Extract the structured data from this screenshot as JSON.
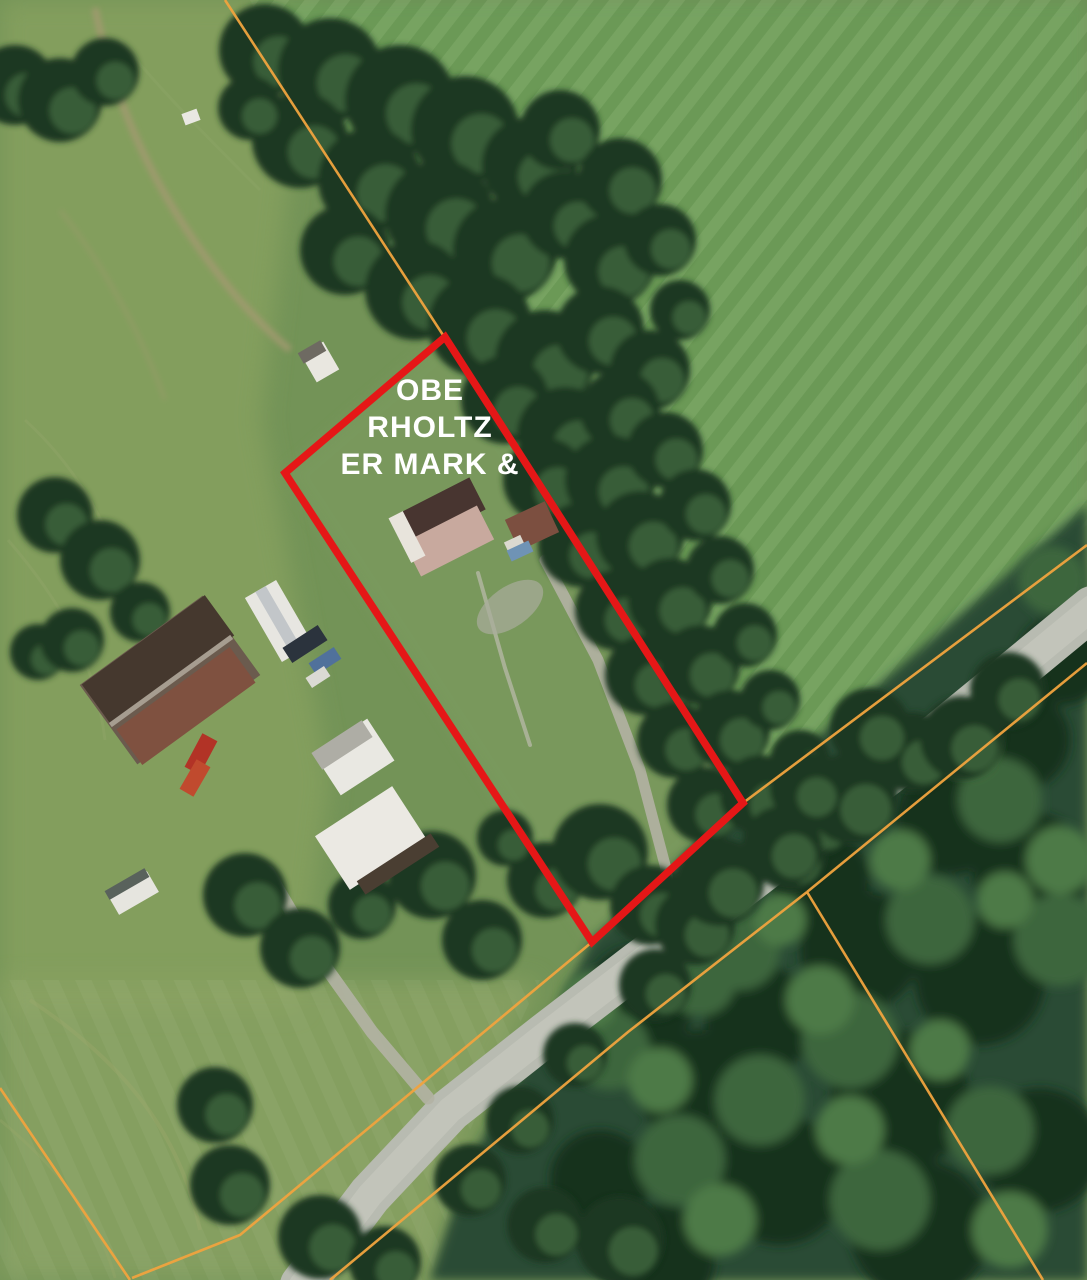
{
  "map": {
    "description": "Aerial parcel map with highlighted parcel",
    "label": {
      "full_text": "OBERHOLTZER MARK &",
      "line1": "OBE",
      "line2": "RHOLTZ",
      "line3": "ER MARK &"
    },
    "colors": {
      "highlight": "#e51717",
      "boundary": "#f0a33e",
      "label": "#ffffff",
      "road": "#b8bbb1",
      "road_center": "#c7cabe",
      "driveway": "#b3b3a4",
      "tree_dark": "#1d3823",
      "tree_light": "#55824b",
      "field_base": "#739357",
      "field_olive": "#86a05f",
      "field_bright": "#6f9f5a",
      "parcel_grass": "#7d9c60",
      "forest": "#2b4c34",
      "dirt": "#a59a72"
    },
    "red_parcel_points": "445,337 743,803 592,942 285,473",
    "orange_lines": [
      "225,0 443,335",
      "1087,545 743,803 592,942 240,1235 132,1278",
      "1087,663 807,892",
      "807,892 1043,1280",
      "807,892 628,1032 330,1280",
      "0,1088 130,1280"
    ],
    "road": {
      "main": "302,1285 370,1195 450,1110 545,1035 640,962 730,895 830,818 940,733 1035,655 1092,608",
      "farm_drive": "268,872 315,952 372,1032 428,1098",
      "parcel_drive": "545,560 598,660 640,770 665,865 680,945",
      "footpath": "478,573 505,668 530,745"
    },
    "scene": {
      "trees": [
        [
          265,
          50,
          46
        ],
        [
          330,
          70,
          52
        ],
        [
          400,
          100,
          55
        ],
        [
          465,
          130,
          54
        ],
        [
          530,
          165,
          48
        ],
        [
          300,
          140,
          48
        ],
        [
          370,
          180,
          52
        ],
        [
          440,
          215,
          55
        ],
        [
          505,
          250,
          52
        ],
        [
          565,
          215,
          44
        ],
        [
          610,
          260,
          46
        ],
        [
          345,
          250,
          45
        ],
        [
          415,
          290,
          50
        ],
        [
          480,
          325,
          52
        ],
        [
          545,
          360,
          50
        ],
        [
          600,
          330,
          44
        ],
        [
          650,
          370,
          40
        ],
        [
          560,
          130,
          40
        ],
        [
          620,
          180,
          42
        ],
        [
          660,
          240,
          36
        ],
        [
          680,
          310,
          30
        ],
        [
          505,
          400,
          44
        ],
        [
          565,
          435,
          48
        ],
        [
          620,
          410,
          40
        ],
        [
          545,
          480,
          42
        ],
        [
          610,
          480,
          45
        ],
        [
          665,
          450,
          38
        ],
        [
          580,
          545,
          42
        ],
        [
          640,
          535,
          44
        ],
        [
          695,
          505,
          36
        ],
        [
          615,
          610,
          40
        ],
        [
          670,
          600,
          42
        ],
        [
          720,
          570,
          34
        ],
        [
          645,
          675,
          40
        ],
        [
          700,
          665,
          40
        ],
        [
          745,
          635,
          32
        ],
        [
          675,
          740,
          38
        ],
        [
          730,
          730,
          40
        ],
        [
          770,
          700,
          30
        ],
        [
          705,
          805,
          38
        ],
        [
          760,
          795,
          40
        ],
        [
          800,
          760,
          30
        ],
        [
          790,
          855,
          36
        ],
        [
          820,
          825,
          30
        ],
        [
          250,
          108,
          32
        ],
        [
          15,
          85,
          40
        ],
        [
          60,
          100,
          42
        ],
        [
          105,
          72,
          34
        ],
        [
          55,
          515,
          38
        ],
        [
          100,
          560,
          40
        ],
        [
          140,
          612,
          30
        ],
        [
          38,
          652,
          28
        ],
        [
          72,
          640,
          32
        ],
        [
          245,
          895,
          42
        ],
        [
          300,
          948,
          40
        ],
        [
          362,
          905,
          34
        ],
        [
          432,
          875,
          44
        ],
        [
          482,
          940,
          40
        ],
        [
          545,
          880,
          38
        ],
        [
          505,
          838,
          28
        ],
        [
          600,
          852,
          48
        ],
        [
          650,
          905,
          40
        ],
        [
          215,
          1105,
          38
        ],
        [
          230,
          1185,
          40
        ],
        [
          320,
          1237,
          42
        ],
        [
          385,
          1262,
          36
        ],
        [
          470,
          1180,
          36
        ],
        [
          520,
          1120,
          34
        ],
        [
          575,
          1055,
          32
        ],
        [
          620,
          1240,
          44
        ],
        [
          545,
          1225,
          38
        ],
        [
          695,
          925,
          40
        ],
        [
          655,
          985,
          36
        ],
        [
          720,
          882,
          44
        ],
        [
          782,
          846,
          40
        ],
        [
          852,
          798,
          46
        ],
        [
          912,
          752,
          40
        ],
        [
          962,
          738,
          42
        ],
        [
          870,
          728,
          40
        ],
        [
          806,
          788,
          36
        ],
        [
          1008,
          690,
          38
        ]
      ],
      "forest_blobs": [
        [
          640,
          1000,
          55,
          "#17311f"
        ],
        [
          700,
          1090,
          60,
          "#17311f"
        ],
        [
          780,
          1180,
          65,
          "#17311f"
        ],
        [
          900,
          1100,
          70,
          "#17311f"
        ],
        [
          980,
          980,
          65,
          "#17311f"
        ],
        [
          1030,
          870,
          58,
          "#17311f"
        ],
        [
          860,
          950,
          60,
          "#17311f"
        ],
        [
          760,
          1020,
          55,
          "#17311f"
        ],
        [
          920,
          1230,
          70,
          "#17311f"
        ],
        [
          1040,
          1150,
          62,
          "#17311f"
        ],
        [
          820,
          880,
          50,
          "#17311f"
        ],
        [
          950,
          820,
          55,
          "#17311f"
        ],
        [
          1020,
          740,
          50,
          "#17311f"
        ],
        [
          1062,
          660,
          45,
          "#17311f"
        ],
        [
          600,
          1180,
          50,
          "#17311f"
        ],
        [
          660,
          1260,
          55,
          "#17311f"
        ],
        [
          610,
          1050,
          40,
          "#3c663e"
        ],
        [
          680,
          1160,
          45,
          "#3c663e"
        ],
        [
          760,
          1100,
          45,
          "#3c663e"
        ],
        [
          850,
          1040,
          48,
          "#3c663e"
        ],
        [
          930,
          920,
          44,
          "#3c663e"
        ],
        [
          1000,
          800,
          42,
          "#3c663e"
        ],
        [
          1060,
          940,
          46,
          "#3c663e"
        ],
        [
          880,
          1200,
          50,
          "#3c663e"
        ],
        [
          990,
          1130,
          44,
          "#3c663e"
        ],
        [
          740,
          950,
          40,
          "#3c663e"
        ],
        [
          1052,
          580,
          34,
          "#3c663e"
        ],
        [
          700,
          980,
          36,
          "#3c663e"
        ],
        [
          590,
          1000,
          28,
          "#4e7a46"
        ],
        [
          660,
          1080,
          32,
          "#4e7a46"
        ],
        [
          820,
          1000,
          34,
          "#4e7a46"
        ],
        [
          900,
          860,
          30,
          "#4e7a46"
        ],
        [
          970,
          750,
          28,
          "#4e7a46"
        ],
        [
          1060,
          860,
          34,
          "#4e7a46"
        ],
        [
          850,
          1130,
          34,
          "#4e7a46"
        ],
        [
          940,
          1050,
          30,
          "#4e7a46"
        ],
        [
          1010,
          1230,
          38,
          "#4e7a46"
        ],
        [
          720,
          1220,
          36,
          "#4e7a46"
        ],
        [
          780,
          920,
          26,
          "#4e7a46"
        ],
        [
          1005,
          900,
          28,
          "#4e7a46"
        ]
      ],
      "buildings": [
        [
          "barn-base",
          170,
          680,
          152,
          98,
          -36,
          "#6b5b4e"
        ],
        [
          "barn-roof-dark",
          158,
          660,
          152,
          50,
          -36,
          "#45382e"
        ],
        [
          "barn-roof-rust",
          186,
          706,
          140,
          44,
          -36,
          "#7f5140"
        ],
        [
          "barn-ridge",
          171,
          681,
          150,
          5,
          -36,
          "#a69d90"
        ],
        [
          "camper-trailer",
          279,
          621,
          36,
          74,
          -30,
          "#e7e6e1"
        ],
        [
          "camper-stripe",
          279,
          621,
          12,
          74,
          -30,
          "#c2c6c9"
        ],
        [
          "dark-car",
          305,
          644,
          42,
          18,
          -33,
          "#2b333d"
        ],
        [
          "blue-car",
          325,
          661,
          30,
          14,
          -33,
          "#50719b"
        ],
        [
          "white-cart",
          318,
          677,
          22,
          12,
          -33,
          "#dbdad4"
        ],
        [
          "outbuilding-west",
          354,
          757,
          64,
          50,
          -33,
          "#e9e8e2"
        ],
        [
          "outbuilding-west-gray",
          342,
          745,
          60,
          20,
          -33,
          "#aeada5"
        ],
        [
          "outbuilding-south",
          371,
          838,
          92,
          64,
          -33,
          "#ebe9e3"
        ],
        [
          "outbuilding-south-dark",
          398,
          864,
          88,
          16,
          -33,
          "#4a3e32"
        ],
        [
          "red-car-1",
          201,
          754,
          17,
          38,
          28,
          "#b23326"
        ],
        [
          "red-car-2",
          195,
          778,
          16,
          34,
          30,
          "#c04a2e"
        ],
        [
          "small-trailer",
          133,
          893,
          46,
          24,
          -30,
          "#e6e5df"
        ],
        [
          "small-trailer-top",
          127,
          884,
          46,
          10,
          -30,
          "#59625c"
        ],
        [
          "field-shed",
          320,
          362,
          26,
          32,
          -30,
          "#e9e7e0"
        ],
        [
          "field-shed-roof",
          312,
          352,
          26,
          12,
          -30,
          "#6e6a62"
        ],
        [
          "white-dot-structure",
          191,
          117,
          16,
          12,
          -20,
          "#e9e8e2"
        ],
        [
          "house-roof-dark",
          441,
          512,
          82,
          36,
          -27,
          "#483530"
        ],
        [
          "house-roof-light",
          449,
          541,
          82,
          38,
          -27,
          "#c8a99e"
        ],
        [
          "house-gable",
          407,
          537,
          16,
          50,
          -27,
          "#e8e4dc"
        ],
        [
          "east-shed",
          532,
          526,
          44,
          34,
          -25,
          "#7c4f40"
        ],
        [
          "east-shed-white",
          515,
          545,
          18,
          14,
          -25,
          "#dcd9d0"
        ],
        [
          "pool",
          520,
          551,
          24,
          12,
          -25,
          "#6f93b5"
        ]
      ]
    }
  }
}
